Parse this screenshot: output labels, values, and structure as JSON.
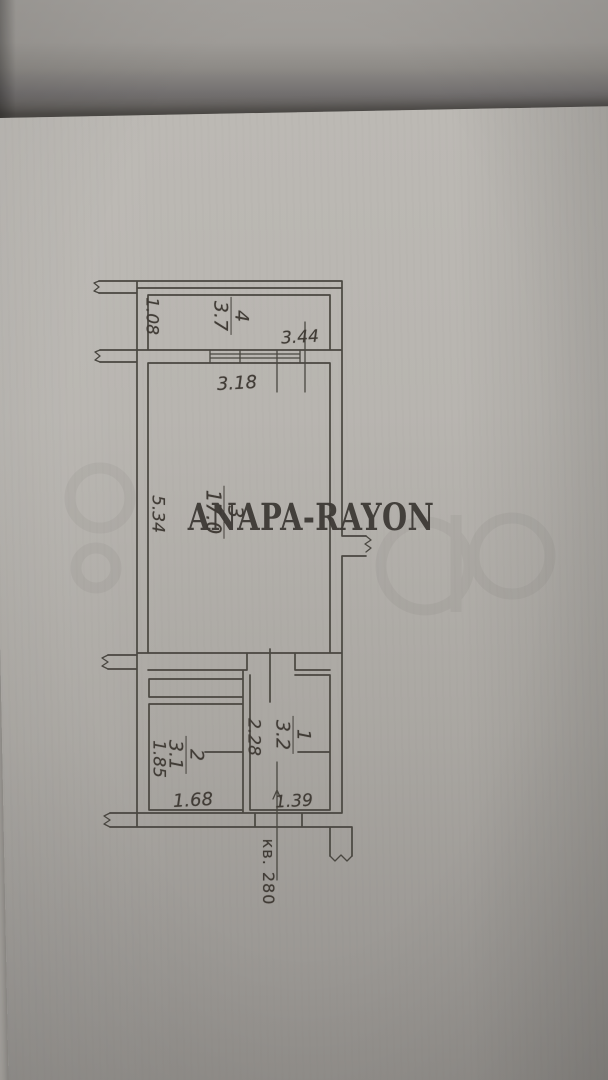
{
  "photo": {
    "watermark": "ANAPA-RAYON"
  },
  "colors": {
    "paper": "#b5b2ad",
    "ink": "#45413c",
    "watermark": "#3d3935"
  },
  "floor_plan": {
    "apartment_label": "кв. 280",
    "rooms": [
      {
        "number": "4",
        "area": "3.7"
      },
      {
        "number": "3",
        "area": "17.0"
      },
      {
        "number": "2",
        "area": "3.1"
      },
      {
        "number": "1",
        "area": "3.2"
      }
    ],
    "dimensions": {
      "room4_depth": "1.08",
      "room4_width": "3.44",
      "room3_window": "3.18",
      "room3_depth": "5.34",
      "room1_depth": "2.28",
      "room2_depth": "1.85",
      "room2_width": "1.68",
      "room1_width": "1.39"
    }
  }
}
